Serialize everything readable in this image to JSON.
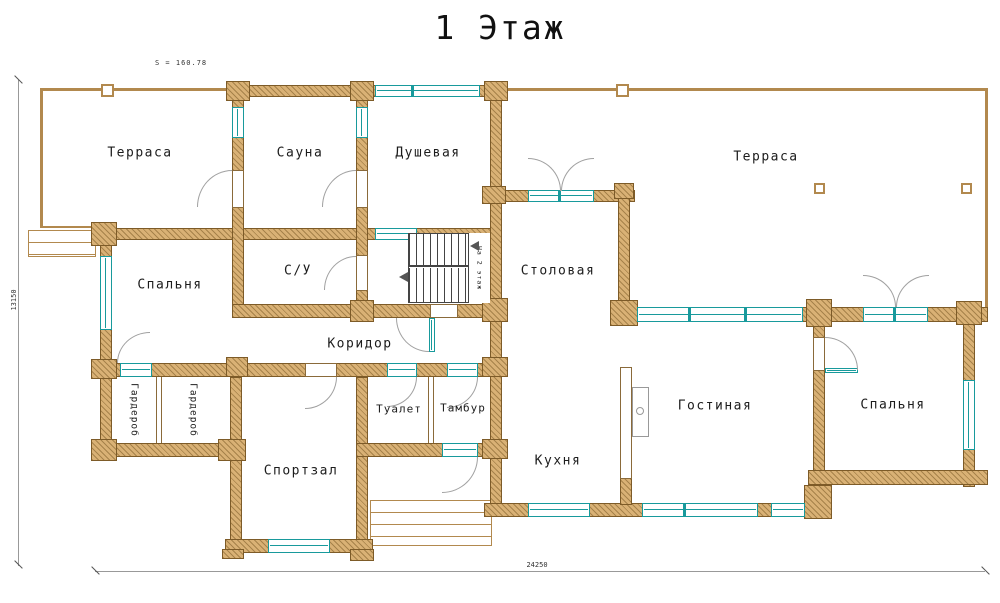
{
  "title": "1 Этаж",
  "area_label": "S = 160.78",
  "rooms": {
    "terrace_left": "Терраса",
    "terrace_right": "Терраса",
    "sauna": "Сауна",
    "shower": "Душевая",
    "bedroom_left": "Спальня",
    "bedroom_right": "Спальня",
    "wc": "С/У",
    "dining": "Столовая",
    "corridor": "Коридор",
    "wardrobe_1": "Гардероб",
    "wardrobe_2": "Гардероб",
    "toilet": "Туалет",
    "vestibule": "Тамбур",
    "gym": "Спортзал",
    "kitchen": "Кухня",
    "living": "Гостиная"
  },
  "stairs": {
    "label": "На 2 этаж"
  },
  "dimensions": {
    "bottom": "24250",
    "left": "13150"
  },
  "colors": {
    "wall_fill": "#d9b175",
    "wall_outline": "#7d5b28",
    "window_teal": "#189a9c",
    "door_arc": "#a0a0a0",
    "terrace_line": "#b2894e"
  }
}
